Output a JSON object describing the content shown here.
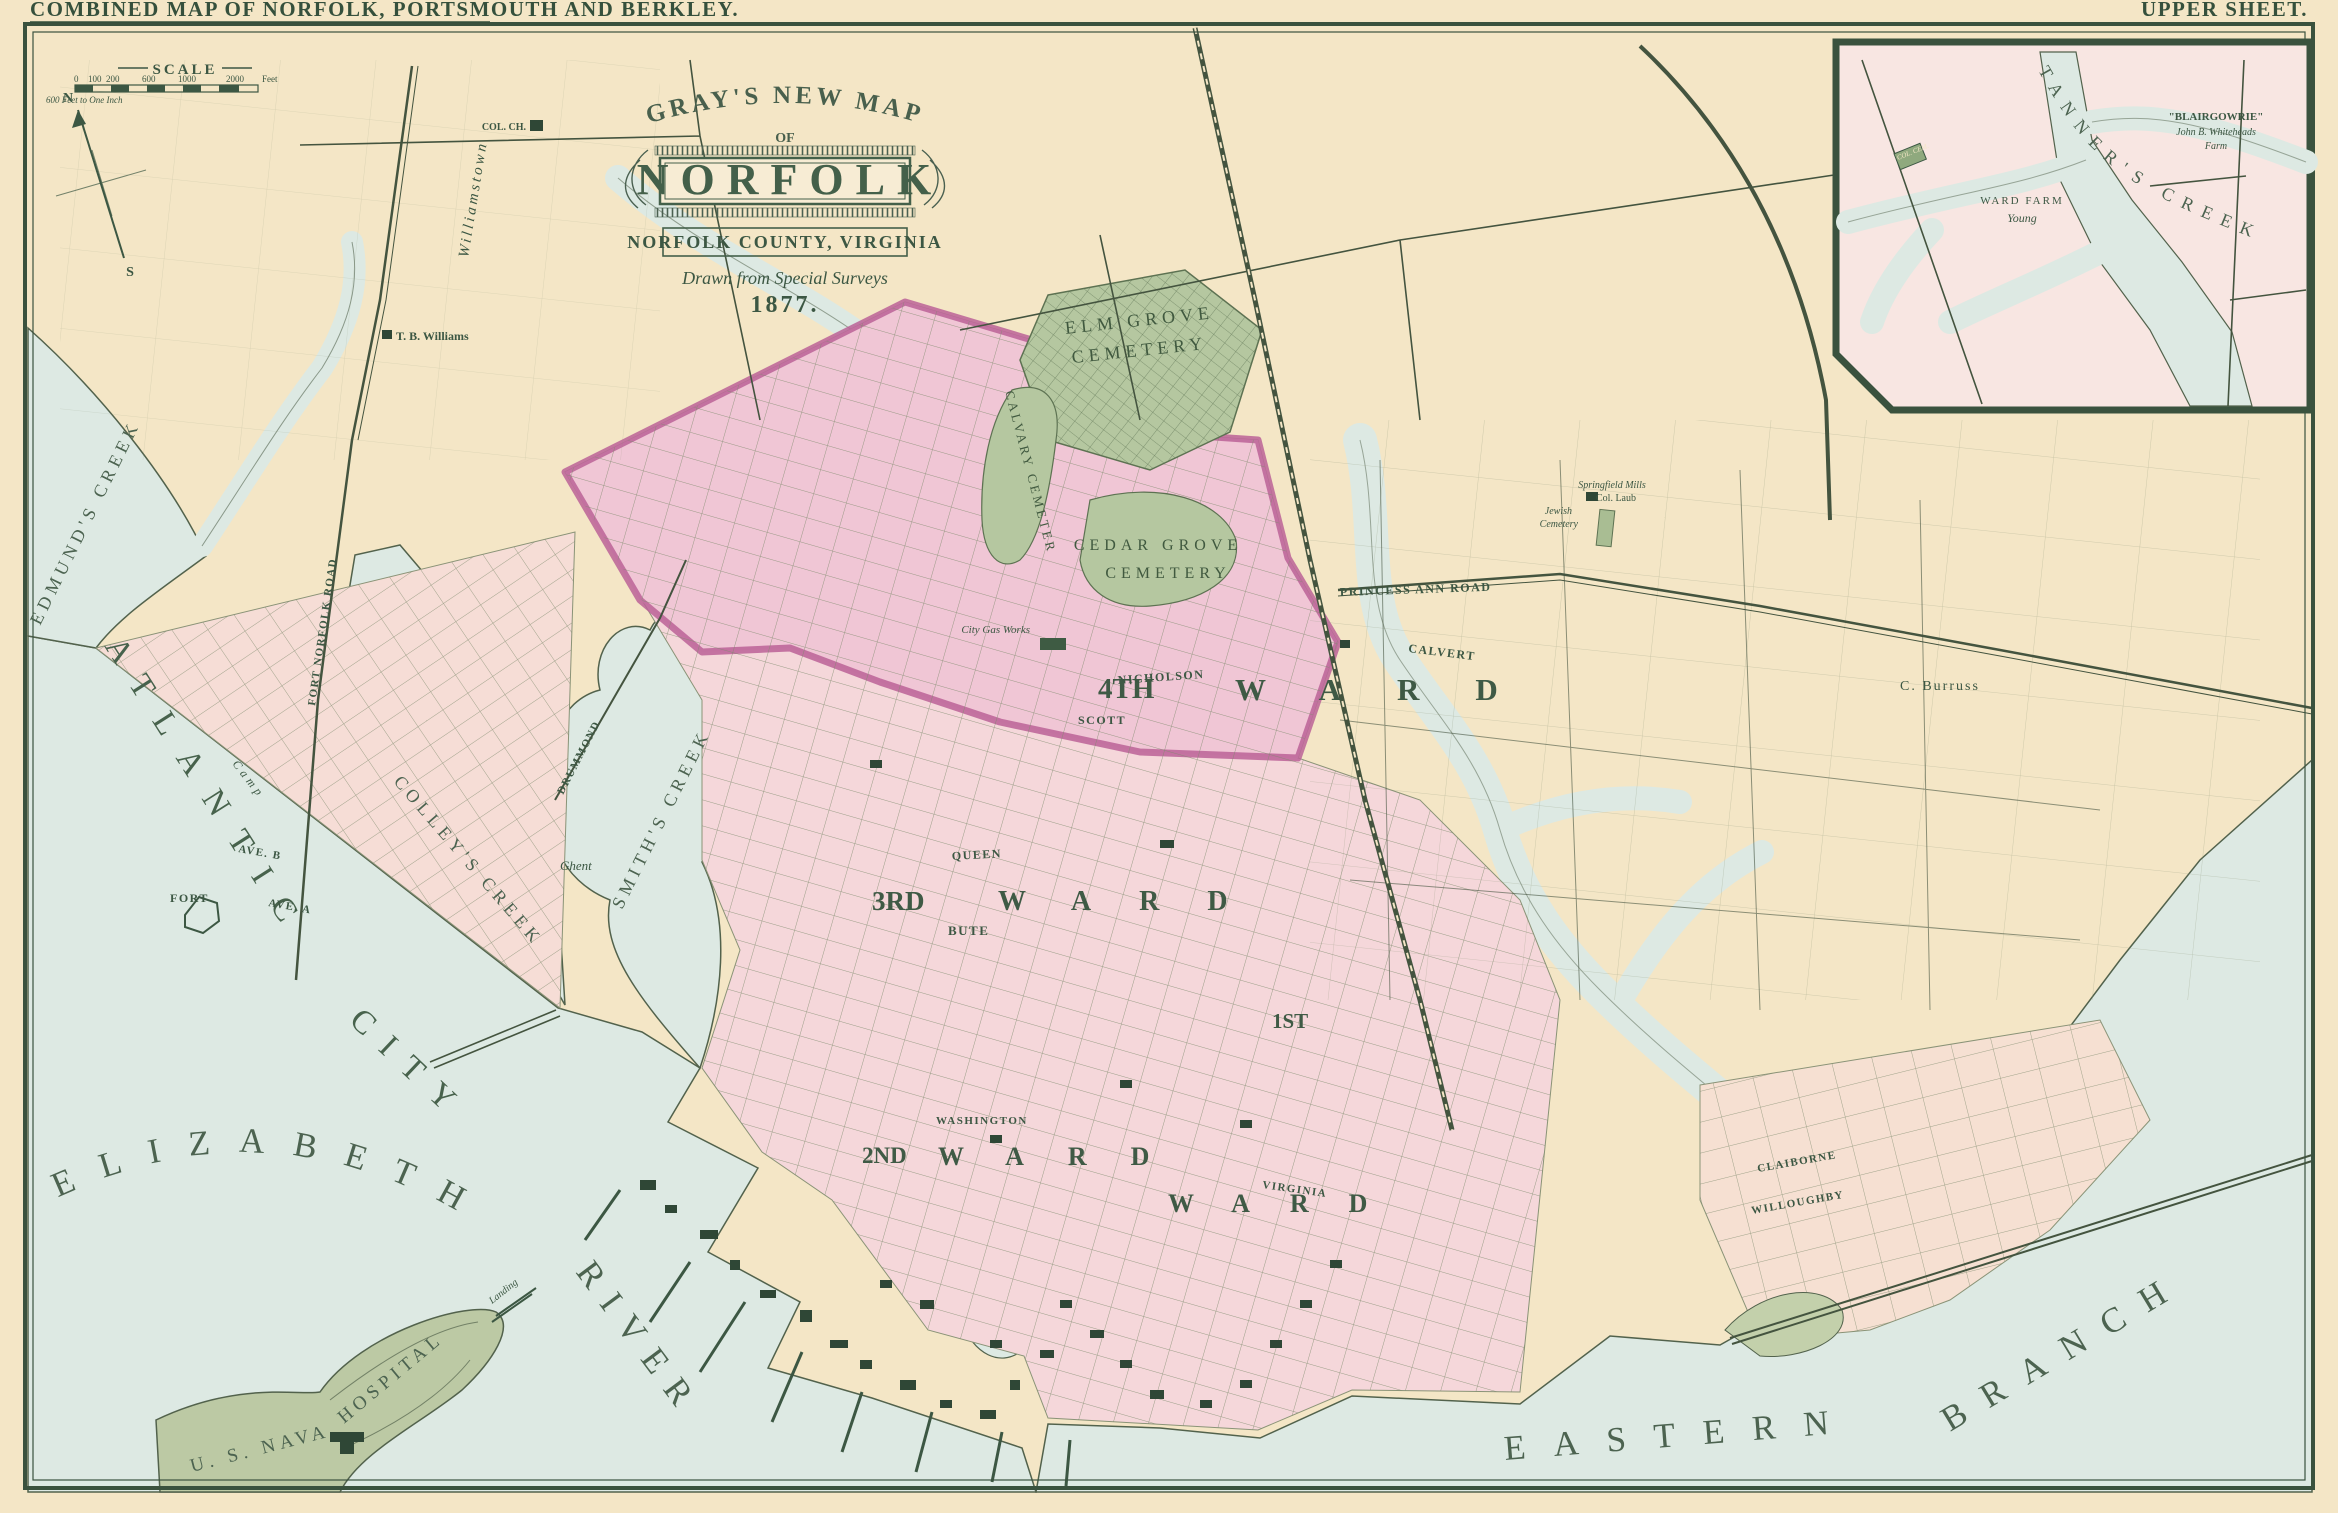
{
  "header": {
    "left_title": "COMBINED MAP OF NORFOLK, PORTSMOUTH AND BERKLEY.",
    "right_title": "UPPER SHEET."
  },
  "title_cartouche": {
    "arc": "GRAY'S NEW MAP",
    "of": "OF",
    "city": "NORFOLK",
    "county": "NORFOLK COUNTY, VIRGINIA",
    "drawn": "Drawn from Special Surveys",
    "year": "1877."
  },
  "scale_bar": {
    "label": "SCALE",
    "note": "600 Feet to One Inch",
    "ticks": [
      "0",
      "100",
      "200",
      "600",
      "1000",
      "2000"
    ],
    "unit": "Feet"
  },
  "compass": {
    "north": "N",
    "south": "S"
  },
  "inset": {
    "creek": "TANNER'S CREEK",
    "blairgowrie": "\"BLAIRGOWRIE\"",
    "owner": "John B. Whiteheads",
    "farm": "Farm",
    "ward_farm": "WARD FARM",
    "young": "Young",
    "col_cem": "COL. CEM."
  },
  "waters": {
    "elizabeth": "ELIZABETH",
    "river": "RIVER",
    "eastern": "EASTERN",
    "branch": "BRANCH",
    "edmunds": "EDMUND'S CREEK",
    "colleys": "COLLEY'S CREEK",
    "smiths": "SMITH'S CREEK"
  },
  "districts": {
    "atlantic": "ATLANTIC",
    "city": "CITY",
    "ward4_num": "4TH",
    "ward4": "WARD",
    "ward3_num": "3RD",
    "ward3": "WARD",
    "ward2_num": "2ND",
    "ward2": "WARD",
    "ward1_num": "1ST",
    "ward1": "WARD"
  },
  "cemeteries": {
    "elm1": "ELM GROVE",
    "elm2": "CEMETERY",
    "calvary": "CALVARY CEMETERY",
    "cedar1": "CEDAR GROVE",
    "cedar2": "CEMETERY",
    "jewish1": "Jewish",
    "jewish2": "Cemetery"
  },
  "places": {
    "hospital1": "U. S. NAVAL",
    "hospital2": "HOSPITAL",
    "landing": "Landing",
    "fort": "FORT",
    "camp": "Camp",
    "ghent": "Ghent",
    "williamstown": "Williamstown",
    "tb_williams": "T. B. Williams",
    "col_ch": "COL. CH.",
    "gas_works": "City Gas Works",
    "springfield1": "Springfield Mills",
    "springfield2": "Col. Laub",
    "burruss": "C. Burruss"
  },
  "streets": {
    "princess_ann": "PRINCESS ANN ROAD",
    "fort_norfolk": "FORT NORFOLK ROAD",
    "drummond": "DRUMMOND",
    "nicholson": "NICHOLSON",
    "scott": "SCOTT",
    "calvert": "CALVERT",
    "queen": "QUEEN",
    "bute": "BUTE",
    "washington": "WASHINGTON",
    "virginia": "VIRGINIA",
    "claiborne": "CLAIBORNE",
    "willoughby": "WILLOUGHBY",
    "ave_a": "AVE. A",
    "ave_b": "AVE. B"
  }
}
